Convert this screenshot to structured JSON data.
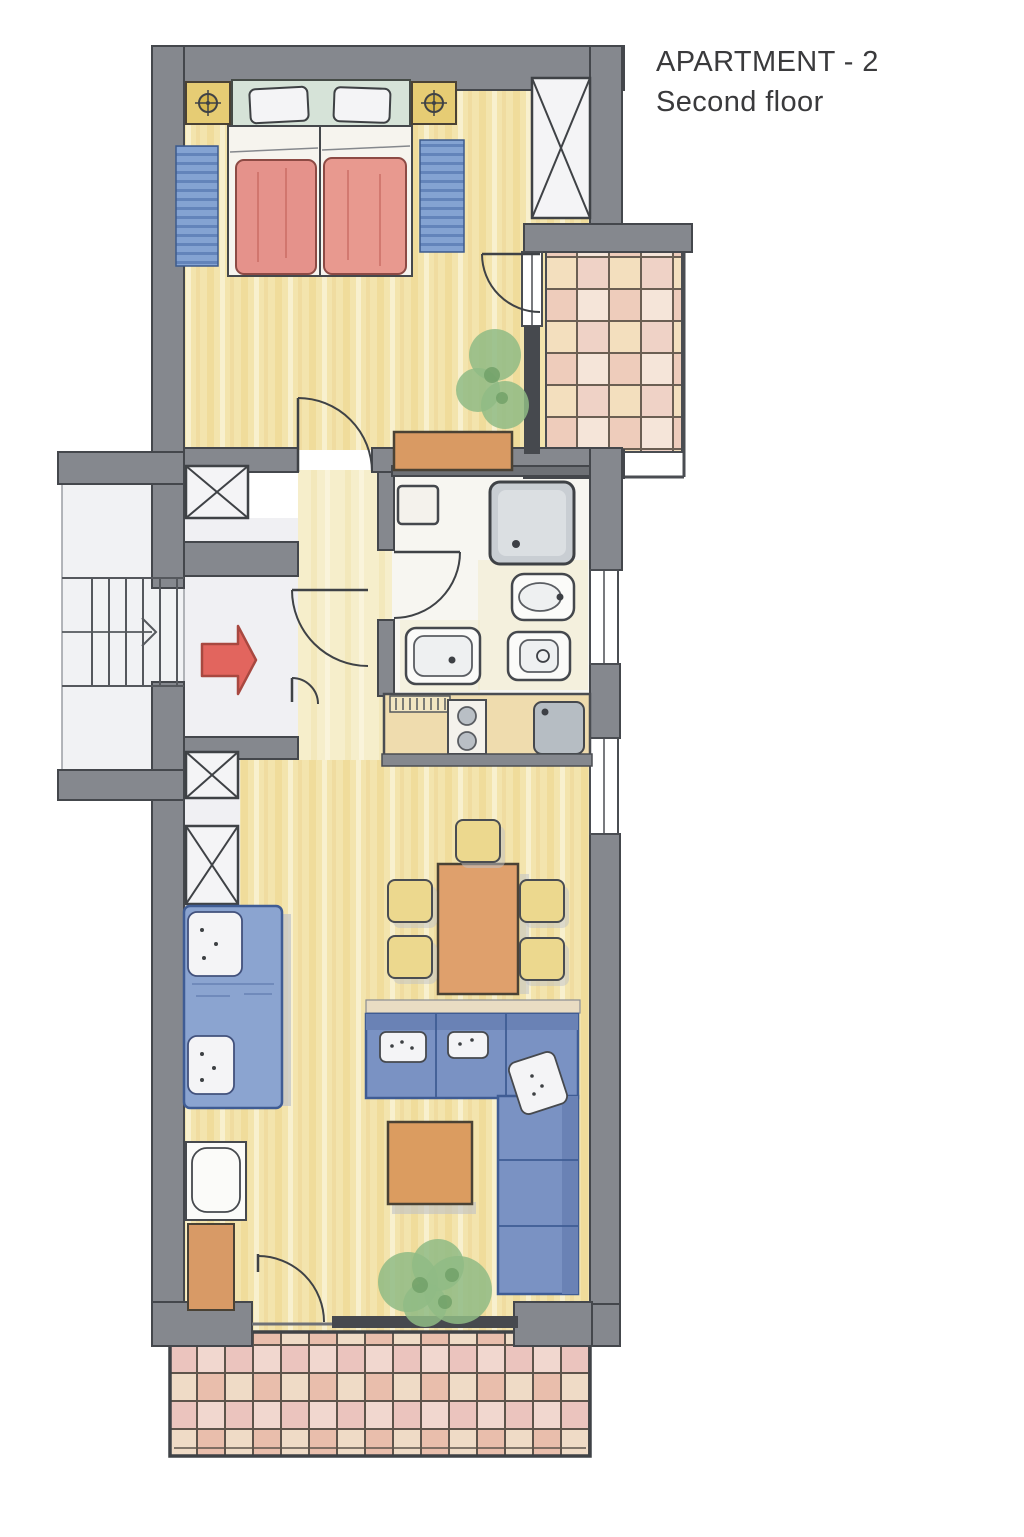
{
  "title": {
    "line1": "APARTMENT - 2",
    "line2": "Second floor"
  },
  "colors": {
    "wall": "#85888e",
    "wallEdge": "#44474c",
    "lineDark": "#3f4246",
    "woodBase": "#f3e4ad",
    "woodPaleBase": "#f6eecb",
    "hallFloor": "#f0f0f3",
    "bathFloor": "#f7f6f1",
    "landingFloor": "#f1f2f4",
    "tileTopBase": "#f2dcd6",
    "tileBottomBase": "#eccfca",
    "tileGrid": "#5e544b",
    "headboard": "#d6e3d8",
    "blanket": "#e5928b",
    "nightstand": "#e6cc74",
    "rug": "#84a3d2",
    "rugStripe": "#5d7fb6",
    "sofa": "#7a92c3",
    "sofaEdge": "#6a82b5",
    "daybed": "#8ba4d0",
    "pillow": "#f4f4f6",
    "diningTable": "#dfa06c",
    "chair": "#ecd88e",
    "coffeeTable": "#db9c60",
    "cabinet": "#d89a66",
    "sideboard": "#d99a63",
    "counter": "#efdcae",
    "appliance": "#f4f2ec",
    "sink": "#b6bdc3",
    "shower": "#c9ced3",
    "plant": "#8fbb85",
    "plantDark": "#6f9f66",
    "glass": "#46494e",
    "arrow": "#e2655e",
    "arrowEdge": "#a84840",
    "shadow": "#bfc2c7",
    "title": "#3a3a3c"
  },
  "plan": {
    "rooms": [
      "bedroom",
      "hallway",
      "entrance-hall",
      "bathroom",
      "kitchen",
      "living-dining-room",
      "staircase-landing",
      "upper-balcony",
      "lower-balcony"
    ],
    "furniture": [
      "double-bed",
      "nightstand-with-lamp-left",
      "nightstand-with-lamp-right",
      "bedside-rug-left",
      "bedside-rug-right",
      "built-in-wardrobe-shaft",
      "sideboard",
      "washing-machine",
      "shower",
      "toilet",
      "bidet",
      "washbasin",
      "kitchen-counter",
      "stove",
      "kitchen-sink",
      "dining-table",
      "dining-chairs",
      "corner-sofa",
      "coffee-table",
      "daybed",
      "desk-with-chair",
      "cabinet",
      "potted-plants"
    ],
    "annotations": [
      "entrance-arrow",
      "stair-direction-arrow",
      "door-swings",
      "window-glazing",
      "shaft-x-marks"
    ]
  }
}
